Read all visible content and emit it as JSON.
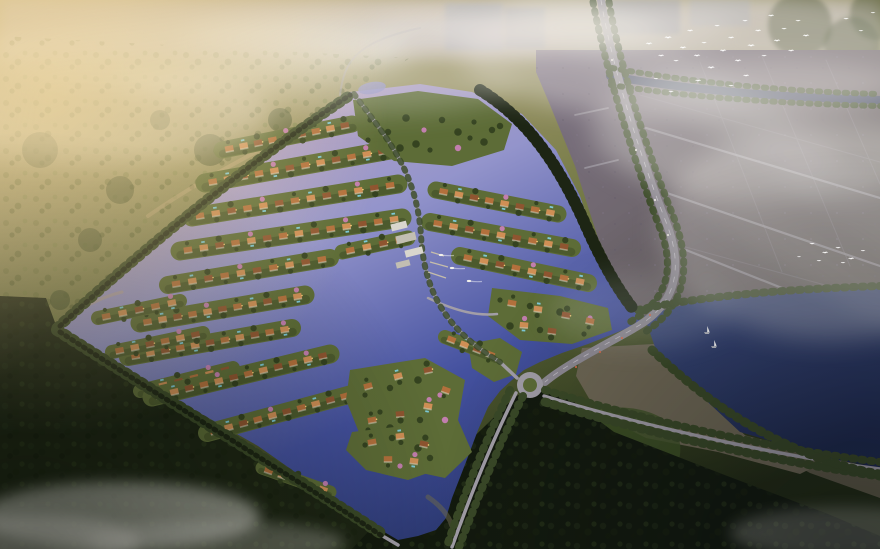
{
  "meta": {
    "width": 880,
    "height": 549,
    "description": "Aerial dusk rendering of a waterfront villa community: canal islands with terracotta-roof villas in lavender water, central marina with boats, tree-lined perimeter roads, highway with roundabout, farmland grid, dark lake with sailboats, forests and fog with flocks of white birds"
  },
  "palette": {
    "haze_warm": "#ecd49a",
    "fog_white": "#efece6",
    "sky_strip": "#cfc5ca",
    "meadow_light": "#9a9466",
    "forest_mid": "#3a4927",
    "forest_dark": "#1d2514",
    "forest_deep": "#131a0e",
    "slope_green": "#3f5226",
    "water_nw": "#c2a9c6",
    "water_mid": "#9394cb",
    "water_se": "#44519f",
    "water_deep": "#2a376f",
    "lake_light": "#3d4c7e",
    "lake": "#1f2a4e",
    "canal": "#3e4660",
    "island": "#5d6c37",
    "island_dark": "#33411f",
    "tree_pink": "#c77fb4",
    "roof": "#b3703c",
    "roof_light": "#cf8f55",
    "roof_dark": "#8f5530",
    "wall": "#e9e2d2",
    "marina_roof": "#d9d6cd",
    "marina_roof2": "#c2beb2",
    "dock": "#cfc5a9",
    "road": "#a29ea7",
    "road_dark": "#8e8a93",
    "road_line": "#cdc9d1",
    "field": "#7b7181",
    "field_dark": "#575247",
    "field_line": "#8c8591",
    "wedge": "#6e6754",
    "sand": "#c8ad82",
    "shallow": "#6b684f",
    "pool": "#7fd4e8",
    "window": "#ffd27a",
    "bird": "#ffffff",
    "boat": "#f2f0ea",
    "car_light": "#ece9e4",
    "car_tail": "#d96a4a"
  },
  "scene": {
    "counts": {
      "villas": 194,
      "birds": 39,
      "sailboats": 2,
      "motorboats": 3
    },
    "villa_rows": [
      [
        222,
        150,
        352,
        124,
        9,
        17
      ],
      [
        205,
        183,
        390,
        150,
        12,
        19
      ],
      [
        192,
        217,
        398,
        184,
        13,
        19
      ],
      [
        180,
        251,
        402,
        218,
        14,
        19
      ],
      [
        168,
        285,
        330,
        258,
        10,
        18
      ],
      [
        342,
        252,
        408,
        238,
        4,
        15
      ],
      [
        140,
        323,
        305,
        295,
        11,
        19
      ],
      [
        128,
        357,
        292,
        328,
        11,
        18
      ],
      [
        98,
        318,
        180,
        301,
        5,
        14
      ],
      [
        112,
        352,
        203,
        333,
        6,
        14
      ],
      [
        140,
        391,
        233,
        368,
        6,
        14
      ],
      [
        152,
        397,
        330,
        354,
        12,
        19
      ],
      [
        207,
        433,
        352,
        394,
        10,
        18
      ],
      [
        262,
        468,
        330,
        492,
        5,
        13
      ],
      [
        372,
        122,
        492,
        112,
        8,
        0
      ],
      [
        382,
        147,
        500,
        140,
        8,
        0
      ],
      [
        436,
        190,
        558,
        214,
        8,
        17
      ],
      [
        430,
        222,
        572,
        248,
        9,
        18
      ],
      [
        460,
        256,
        588,
        283,
        8,
        18
      ],
      [
        445,
        337,
        497,
        357,
        4,
        14
      ]
    ],
    "clusters": [
      {
        "name": "north-island",
        "island": [
          [
            353,
            100
          ],
          [
            418,
            91
          ],
          [
            478,
            99
          ],
          [
            512,
            124
          ],
          [
            504,
            150
          ],
          [
            452,
            166
          ],
          [
            394,
            161
          ],
          [
            358,
            136
          ]
        ],
        "trees": [
          [
            370,
            120
          ],
          [
            388,
            132
          ],
          [
            406,
            118
          ],
          [
            424,
            130
          ],
          [
            442,
            120
          ],
          [
            458,
            132
          ],
          [
            474,
            122
          ],
          [
            492,
            130
          ],
          [
            400,
            148
          ],
          [
            430,
            150
          ],
          [
            458,
            148
          ],
          [
            484,
            142
          ],
          [
            368,
            140
          ],
          [
            500,
            126
          ],
          [
            416,
            144
          ],
          [
            470,
            138
          ]
        ],
        "villas": []
      },
      {
        "name": "east-cluster",
        "island": [
          [
            492,
            288
          ],
          [
            560,
            296
          ],
          [
            608,
            308
          ],
          [
            612,
            330
          ],
          [
            572,
            344
          ],
          [
            520,
            340
          ],
          [
            488,
            316
          ]
        ],
        "trees": [
          [
            500,
            300
          ],
          [
            530,
            306
          ],
          [
            560,
            312
          ],
          [
            590,
            318
          ],
          [
            540,
            330
          ],
          [
            510,
            326
          ],
          [
            584,
            334
          ]
        ],
        "villas": [
          [
            512,
            303,
            10
          ],
          [
            538,
            309,
            8
          ],
          [
            566,
            315,
            10
          ],
          [
            590,
            321,
            12
          ],
          [
            524,
            325,
            5
          ],
          [
            552,
            331,
            8
          ]
        ]
      },
      {
        "name": "peninsula",
        "island": [
          [
            350,
            370
          ],
          [
            425,
            358
          ],
          [
            465,
            380
          ],
          [
            458,
            420
          ],
          [
            472,
            452
          ],
          [
            445,
            478
          ],
          [
            398,
            468
          ],
          [
            362,
            440
          ],
          [
            346,
            400
          ]
        ],
        "trees": [
          [
            365,
            395
          ],
          [
            390,
            388
          ],
          [
            418,
            380
          ],
          [
            440,
            395
          ],
          [
            420,
            420
          ],
          [
            390,
            428
          ],
          [
            368,
            430
          ],
          [
            408,
            448
          ],
          [
            432,
            452
          ],
          [
            380,
            412
          ],
          [
            445,
            420
          ]
        ],
        "villas": [
          [
            368,
            386,
            -15
          ],
          [
            398,
            376,
            -15
          ],
          [
            428,
            370,
            -12
          ],
          [
            446,
            390,
            20
          ],
          [
            428,
            406,
            10
          ],
          [
            400,
            414,
            -5
          ],
          [
            372,
            420,
            -10
          ],
          [
            394,
            440,
            5
          ],
          [
            420,
            436,
            15
          ],
          [
            382,
            455,
            -5
          ]
        ]
      },
      {
        "name": "south-island",
        "island": [
          [
            352,
            432
          ],
          [
            420,
            424
          ],
          [
            448,
            440
          ],
          [
            442,
            468
          ],
          [
            408,
            480
          ],
          [
            366,
            470
          ],
          [
            346,
            450
          ]
        ],
        "trees": [
          [
            365,
            445
          ],
          [
            392,
            438
          ],
          [
            418,
            448
          ],
          [
            400,
            466
          ],
          [
            430,
            458
          ]
        ],
        "villas": [
          [
            372,
            442,
            -10
          ],
          [
            400,
            436,
            -8
          ],
          [
            424,
            444,
            12
          ],
          [
            388,
            459,
            0
          ],
          [
            414,
            461,
            8
          ]
        ]
      }
    ],
    "marina": {
      "buildings": [
        [
          399,
          226,
          16,
          7,
          -14
        ],
        [
          406,
          238,
          20,
          8,
          -14
        ],
        [
          414,
          252,
          18,
          7,
          -14
        ],
        [
          403,
          264,
          14,
          6,
          -14
        ]
      ],
      "docks": [
        [
          430,
          262,
          448,
          267
        ],
        [
          428,
          272,
          446,
          278
        ],
        [
          431,
          252,
          444,
          256
        ]
      ]
    },
    "boats": {
      "motor": [
        [
          452,
          268
        ],
        [
          469,
          281
        ],
        [
          441,
          255
        ]
      ],
      "sail": [
        [
          707,
          331
        ],
        [
          714,
          345
        ]
      ]
    },
    "vehicles": {
      "light": [
        [
          612,
          60
        ],
        [
          636,
          150
        ],
        [
          655,
          200
        ],
        [
          668,
          235
        ]
      ],
      "tail": [
        [
          650,
          315
        ],
        [
          622,
          338
        ],
        [
          600,
          352
        ],
        [
          576,
          367
        ]
      ]
    },
    "birds": [
      [
        649,
        44,
        1
      ],
      [
        661,
        56,
        0.9
      ],
      [
        668,
        38,
        1.1
      ],
      [
        676,
        61,
        0.8
      ],
      [
        683,
        48,
        1
      ],
      [
        690,
        31,
        0.9
      ],
      [
        697,
        56,
        1
      ],
      [
        704,
        43,
        0.8
      ],
      [
        711,
        68,
        1.1
      ],
      [
        717,
        26,
        0.8
      ],
      [
        723,
        51,
        1
      ],
      [
        731,
        38,
        0.9
      ],
      [
        738,
        61,
        1
      ],
      [
        745,
        21,
        0.8
      ],
      [
        751,
        46,
        1.1
      ],
      [
        758,
        31,
        0.9
      ],
      [
        764,
        56,
        0.8
      ],
      [
        771,
        16,
        0.9
      ],
      [
        777,
        41,
        1
      ],
      [
        784,
        29,
        0.8
      ],
      [
        791,
        51,
        0.9
      ],
      [
        798,
        21,
        0.8
      ],
      [
        806,
        36,
        1
      ],
      [
        746,
        76,
        0.9
      ],
      [
        731,
        86,
        0.8
      ],
      [
        698,
        81,
        0.9
      ],
      [
        671,
        92,
        0.8
      ],
      [
        656,
        79,
        0.7
      ],
      [
        846,
        19,
        0.8
      ],
      [
        861,
        31,
        0.7
      ],
      [
        873,
        13,
        0.7
      ],
      [
        812,
        244,
        0.8
      ],
      [
        825,
        253,
        0.9
      ],
      [
        838,
        248,
        0.8
      ],
      [
        851,
        259,
        0.9
      ],
      [
        863,
        251,
        0.7
      ],
      [
        843,
        263,
        0.7
      ],
      [
        819,
        261,
        0.7
      ],
      [
        799,
        257,
        0.6
      ]
    ]
  }
}
